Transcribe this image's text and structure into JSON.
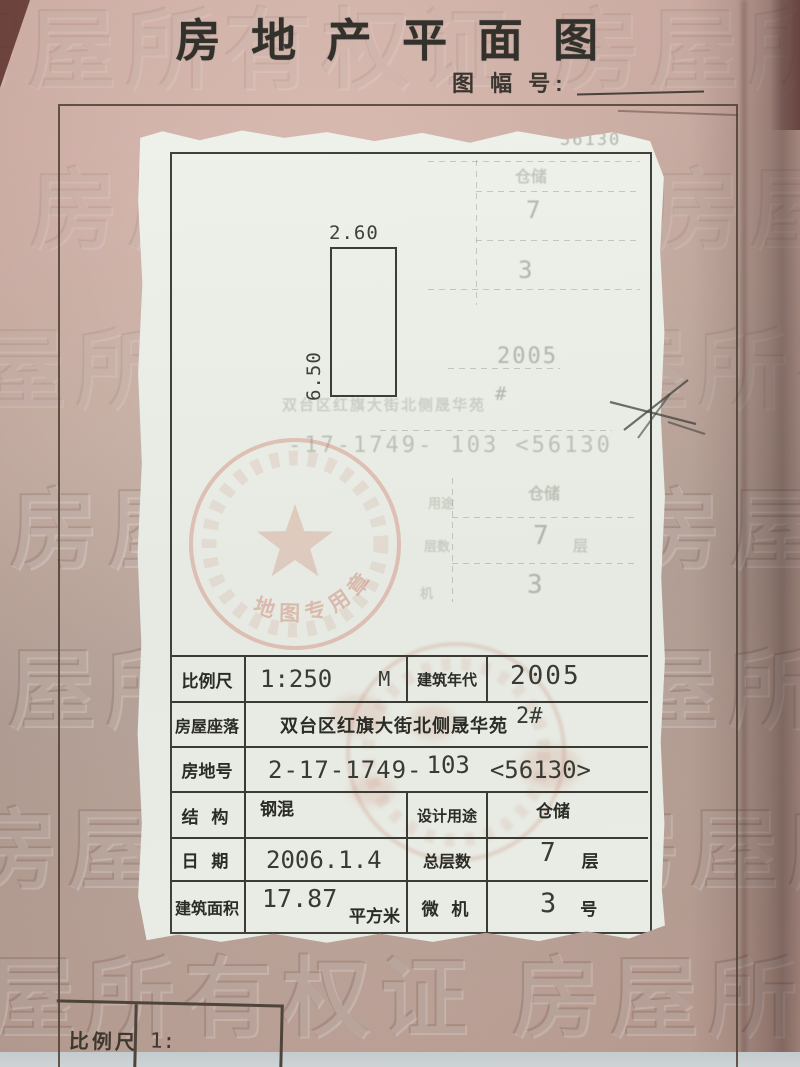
{
  "title": "房 地 产 平 面 图",
  "sheet_label": "图 幅 号:",
  "watermark": {
    "row": "房屋所有权证 房屋所有权证"
  },
  "plan": {
    "top_dim": "2.60",
    "side_dim": "6.50"
  },
  "ghosts": {
    "serial_top": "56130",
    "use_top": "仓储",
    "floors_top": "7",
    "micro_top": "3",
    "year": "2005",
    "hash": "#",
    "address": "双台区红旗大街北侧晟华苑",
    "parcel": "-17-1749-  103   <56130",
    "use_label": "用途",
    "use_mid": "仓储",
    "floors_label": "层数",
    "floors_mid": "7",
    "floors_unit": "层",
    "micro_label": "机",
    "micro_mid": "3"
  },
  "stamp": {
    "arc_text": "地图专用章"
  },
  "table": {
    "r1": {
      "label": "比例尺",
      "v1": "1:250",
      "v2": "M",
      "label2": "建筑年代",
      "v3": "2005"
    },
    "r2": {
      "label": "房屋座落",
      "v1": "双台区红旗大街北侧晟华苑",
      "v2": "2#"
    },
    "r3": {
      "label": "房地号",
      "v1": "2-17-1749-",
      "v2": "103",
      "v3": "<56130>"
    },
    "r4": {
      "label": "结 构",
      "v1": "钢混",
      "label2": "设计用途",
      "v3": "仓储"
    },
    "r5": {
      "label": "日 期",
      "v1": "2006.1.4",
      "label2": "总层数",
      "v3": "7",
      "unit": "层"
    },
    "r6": {
      "label": "建筑面积",
      "v1": "17.87",
      "mid": "平方米",
      "label2": "微 机",
      "v3": "3",
      "unit": "号"
    }
  },
  "footer": {
    "label": "比例尺",
    "value": "1:"
  },
  "colors": {
    "page_pink": "#cdb2a8",
    "paper_white": "#e9ece5",
    "stamp_red": "#c5806f",
    "ink": "#35372f"
  }
}
